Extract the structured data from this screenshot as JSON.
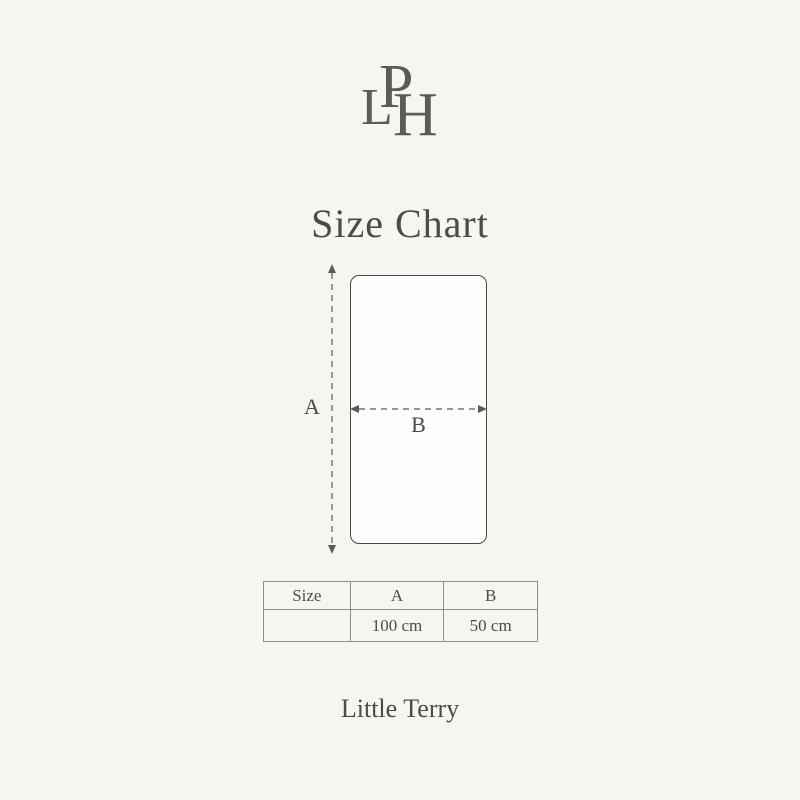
{
  "page": {
    "background_color": "#f6f5f1",
    "text_color": "#4c4b47"
  },
  "logo": {
    "letter_1": "L",
    "letter_2": "P",
    "letter_3": "H"
  },
  "title": "Size Chart",
  "diagram": {
    "shape": "rounded-rectangle",
    "height_label": "A",
    "width_label": "B"
  },
  "table": {
    "headers": [
      "Size",
      "A",
      "B"
    ],
    "rows": [
      [
        "",
        "100 cm",
        "50 cm"
      ]
    ]
  },
  "product_name": "Little Terry"
}
